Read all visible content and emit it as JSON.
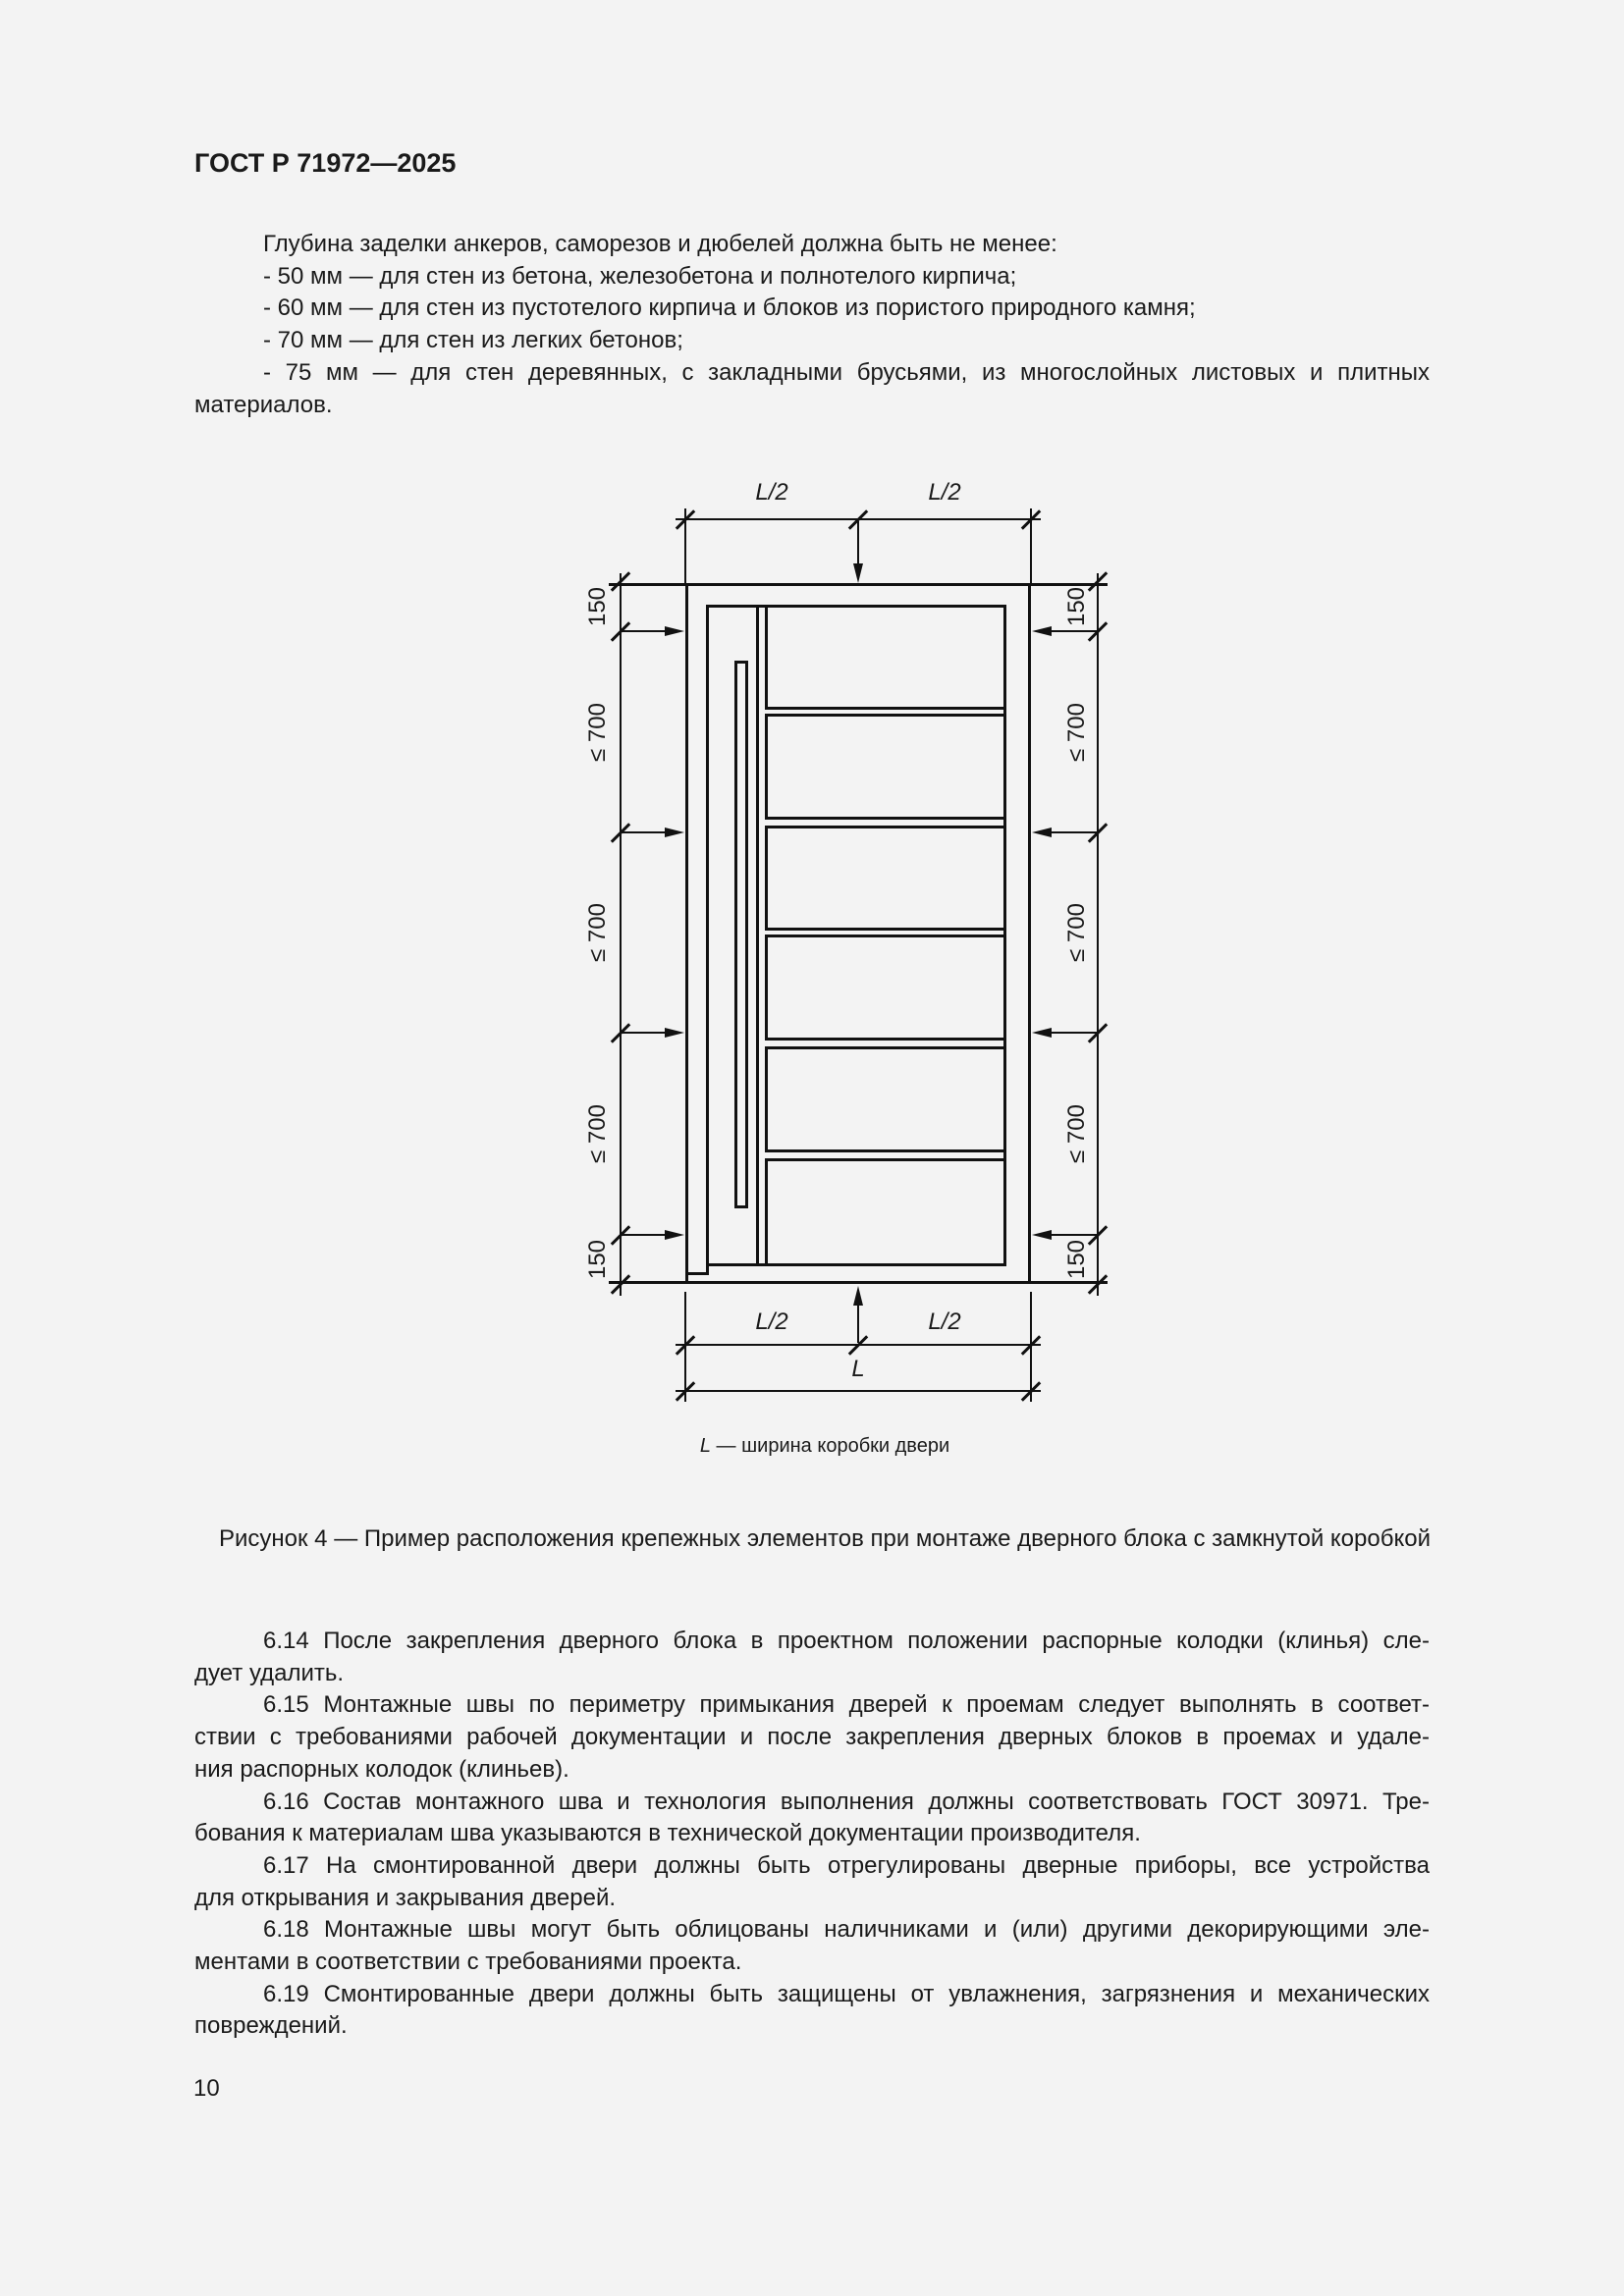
{
  "page": {
    "code": "ГОСТ Р 71972—2025",
    "number": "10"
  },
  "intro": {
    "lines": [
      "Глубина заделки анкеров, саморезов и дюбелей должна быть не менее:",
      "- 50 мм — для стен из бетона, железобетона и полнотелого кирпича;",
      "- 60 мм — для стен из пустотелого кирпича и блоков из пористого природного камня;",
      "- 70 мм — для стен из легких бетонов;",
      "- 75 мм — для стен деревянных, с закладными брусьями, из многослойных листовых и плитных",
      "материалов."
    ]
  },
  "figure": {
    "caption": "Рисунок 4 — Пример расположения крепежных элементов при монтаже дверного блока с замкнутой коробкой",
    "legend_symbol": "L",
    "legend_text": " — ширина коробки двери",
    "dims": {
      "half_width": "L/2",
      "full_width": "L",
      "edge_offset": "150",
      "max_spacing": "≤ 700"
    }
  },
  "body": {
    "lines": [
      "6.14 После закрепления дверного блока в проектном положении распорные колодки (клинья) сле-",
      "дует удалить.",
      "6.15 Монтажные швы по периметру примыкания дверей к проемам следует выполнять в соответ-",
      "ствии с требованиями рабочей документации и после закрепления дверных блоков в проемах и удале-",
      "ния распорных колодок (клиньев).",
      "6.16 Состав монтажного шва и технология выполнения должны соответствовать ГОСТ 30971. Тре-",
      "бования к материалам шва указываются в технической документации производителя.",
      "6.17 На смонтированной двери должны быть отрегулированы дверные приборы, все устройства",
      "для открывания и закрывания дверей.",
      "6.18 Монтажные швы могут быть облицованы наличниками и (или) другими декорирующими эле-",
      "ментами в соответствии с требованиями проекта.",
      "6.19 Смонтированные двери должны быть защищены от увлажнения, загрязнения и механических",
      "повреждений."
    ]
  }
}
